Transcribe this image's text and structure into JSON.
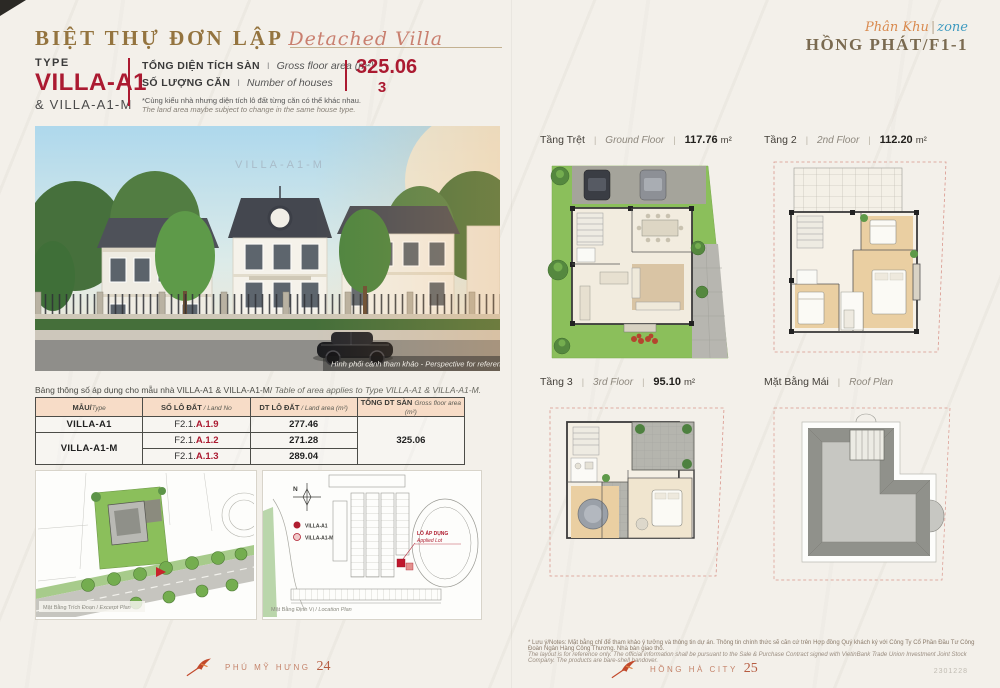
{
  "sep": "|",
  "header": {
    "title_vi": "BIỆT THỰ ĐƠN LẬP",
    "title_en": "Detached Villa",
    "zone": {
      "script_vi": "Phân Khu",
      "sep": "|",
      "script_en": "zone",
      "name": "HỒNG PHÁT/F1-1"
    }
  },
  "spec": {
    "type_label": "TYPE",
    "type_value": "VILLA-A1",
    "type_sub": "& VILLA-A1-M",
    "gross_label_vi": "TỔNG DIỆN TÍCH SÀN",
    "gross_sep": "I",
    "gross_label_en": "Gross floor area (m²)",
    "gross_value": "325.06",
    "count_label_vi": "SỐ LƯỢNG CĂN",
    "count_sep": "I",
    "count_label_en": "Number of houses",
    "count_value": "3",
    "note_vi": "*Cùng kiểu nhà nhưng diện tích lô đất từng căn có thể khác nhau.",
    "note_en": "The land area maybe subject to change in the same house type."
  },
  "photo": {
    "watermark": "VILLA-A1-M",
    "caption": "Hình phối cảnh tham khảo - Perspective for reference"
  },
  "table": {
    "caption_vi": "Bảng thông số áp dụng cho mẫu nhà VILLA-A1 & VILLA-A1-M/",
    "caption_en": " Table of area applies to Type VILLA-A1 & VILLA-A1-M.",
    "col_type_vi": "MẪU/",
    "col_type_en": "Type",
    "col_lot_vi": "SỐ LÔ ĐẤT",
    "col_lot_en": " / Land No",
    "col_area_vi": "DT LÔ ĐẤT",
    "col_area_en": " / Land area (m²)",
    "col_total_vi": "TỔNG DT SÀN ",
    "col_total_en": "Gross floor area (m²)",
    "row1_type": "VILLA-A1",
    "row2_type": "VILLA-A1-M",
    "lot1_prefix": "F2.1.",
    "lot1_no": "A.1.9",
    "area1": "277.46",
    "lot2_prefix": "F2.1.",
    "lot2_no": "A.1.2",
    "area2": "271.28",
    "lot3_prefix": "F2.1.",
    "lot3_no": "A.1.3",
    "area3": "289.04",
    "total": "325.06"
  },
  "plans": {
    "ground": {
      "vi": "Tầng Trệt",
      "en": "Ground Floor",
      "area": "117.76",
      "unit": "m²"
    },
    "second": {
      "vi": "Tầng 2",
      "en": "2nd Floor",
      "area": "112.20",
      "unit": "m²"
    },
    "third": {
      "vi": "Tầng 3",
      "en": "3rd Floor",
      "area": "95.10",
      "unit": "m²"
    },
    "roof": {
      "vi": "Mặt Bằng Mái",
      "en": "Roof Plan"
    }
  },
  "site": {
    "excerpt_caption_vi": "Mặt Bằng Trích Đoạn /",
    "excerpt_caption_en": " Excerpt Plan",
    "location_caption_vi": "Mặt Bằng Định Vị /",
    "location_caption_en": " Location Plan",
    "compass": "N",
    "legend_a1": "VILLA-A1",
    "legend_a1m": "VILLA-A1-M",
    "applied_vi": "LÔ ÁP DỤNG",
    "applied_en": "Applied Lot"
  },
  "footer": {
    "left_brand": "PHÚ MỸ HƯNG",
    "left_page": "24",
    "right_brand": "HỒNG HÀ CITY",
    "right_page": "25",
    "note_vi": "* Lưu ý/Notes: Mặt bằng chỉ để tham khảo ý tưởng và thông tin dự án. Thông tin chính thức sẽ căn cứ trên Hợp đồng Quý khách ký với Công Ty Cổ Phần Đầu Tư Công Đoàn Ngân Hàng Công Thương. Nhà bàn giao thô.",
    "note_en": "The layout is for reference only. The official information shall be pursuant to the Sale & Purchase Contract signed with VietinBank Trade Union Investment Joint Stock Company. The products are bare-shell handover.",
    "corner_code": "2301228"
  }
}
